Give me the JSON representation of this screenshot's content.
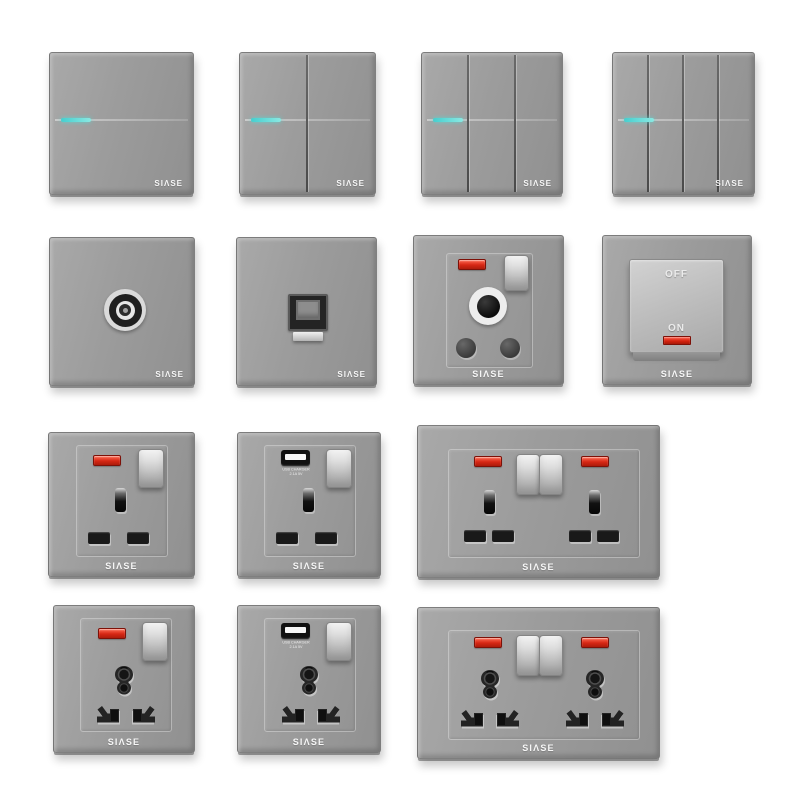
{
  "brand": {
    "name": "SIASE",
    "logo_text": "SIΛSE"
  },
  "labels": {
    "off": "OFF",
    "on": "ON",
    "usb_charger_line1": "USB CHARGER",
    "usb_charger_line2": "2.1A 5V"
  },
  "palette": {
    "background": "#ffffff",
    "plate_gray": "#9b9b9b",
    "led_cyan": "#59d8d4",
    "neon_red": "#d62714",
    "rocker_silver": "#d9d9d9",
    "logo_white": "#f5f5f5"
  },
  "products": [
    {
      "id": "switch-1-gang",
      "type": "rocker-wall-switch",
      "gangs": 1,
      "indicator": "cyan-led"
    },
    {
      "id": "switch-2-gang",
      "type": "rocker-wall-switch",
      "gangs": 2,
      "indicator": "cyan-led"
    },
    {
      "id": "switch-3-gang",
      "type": "rocker-wall-switch",
      "gangs": 3,
      "indicator": "cyan-led"
    },
    {
      "id": "switch-4-gang",
      "type": "rocker-wall-switch",
      "gangs": 4,
      "indicator": "cyan-led"
    },
    {
      "id": "tv-socket",
      "type": "tv-coaxial-socket"
    },
    {
      "id": "lan-socket",
      "type": "ethernet-socket"
    },
    {
      "id": "15a-round-pin-socket",
      "type": "switched-round-pin-socket",
      "indicator": "red-neon"
    },
    {
      "id": "water-heater-switch",
      "type": "on-off-rocker-switch",
      "indicator": "red-neon"
    },
    {
      "id": "uk-13a-socket-neon",
      "type": "switched-uk-socket",
      "indicator": "red-neon"
    },
    {
      "id": "uk-13a-socket-usb",
      "type": "switched-uk-socket-usb"
    },
    {
      "id": "uk-13a-double-socket",
      "type": "double-switched-uk-socket",
      "indicator": "red-neon-x2"
    },
    {
      "id": "universal-socket-neon",
      "type": "switched-universal-socket",
      "indicator": "red-neon"
    },
    {
      "id": "universal-socket-usb",
      "type": "switched-universal-socket-usb"
    },
    {
      "id": "universal-double-socket",
      "type": "double-switched-universal-socket",
      "indicator": "red-neon-x2"
    }
  ]
}
